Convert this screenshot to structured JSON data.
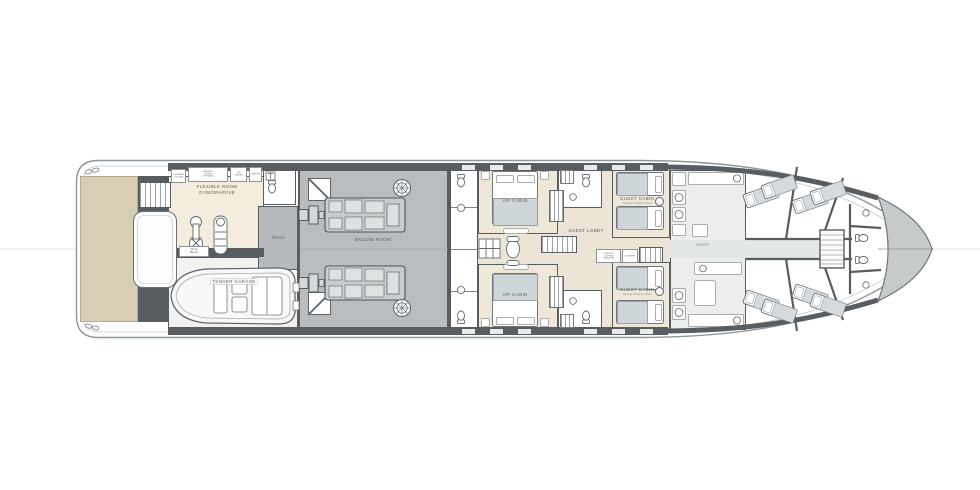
{
  "deck": {
    "rooms": {
      "flexible_room": {
        "label": "FLEXIBLE ROOM",
        "sublabel": "GYM/SPA/DIVE"
      },
      "tech": {
        "label": "TECH"
      },
      "workbench": {
        "label": "Work Bench"
      },
      "tender_garage": {
        "label": "TENDER GARAGE"
      },
      "engine_room": {
        "label": "ENGINE ROOM"
      },
      "vip_cabin_upper": {
        "label": "VIP CABIN"
      },
      "vip_cabin_lower": {
        "label": "VIP CABIN"
      },
      "guest_lobby": {
        "label": "GUEST LOBBY"
      },
      "guest_cabin_upper": {
        "label": "GUEST CABIN",
        "sublabel": "Sliding Pullman Bed"
      },
      "guest_cabin_lower": {
        "label": "GUEST CABIN",
        "sublabel": "Sliding Pullman Bed"
      },
      "pantry": {
        "label": "PANTRY"
      }
    },
    "aft_cabinets": {
      "c1": "STORAGE LOCKER",
      "c2": "WASHER / DRYER STORAGE",
      "c3": "ICE MAKER",
      "c4": "FRIDGE"
    },
    "lobby_units": {
      "fridge_coffee": "FRIDGE / COFFEE MACHINE",
      "storage": "STORAGE"
    }
  },
  "colors": {
    "hull_outline": "#8e979b",
    "walls": "#585d61",
    "engine_room_floor": "#b9bdbf",
    "flexible_room_floor": "#f4eddd",
    "cabin_floor": "#efe8d9",
    "lobby_floor": "#ece5d6",
    "stern_deck": "#d9cdb4",
    "crew_floor": "#eceeed",
    "bow_storage": "#c6cacb",
    "bed_duvet": "#cfd6da"
  }
}
